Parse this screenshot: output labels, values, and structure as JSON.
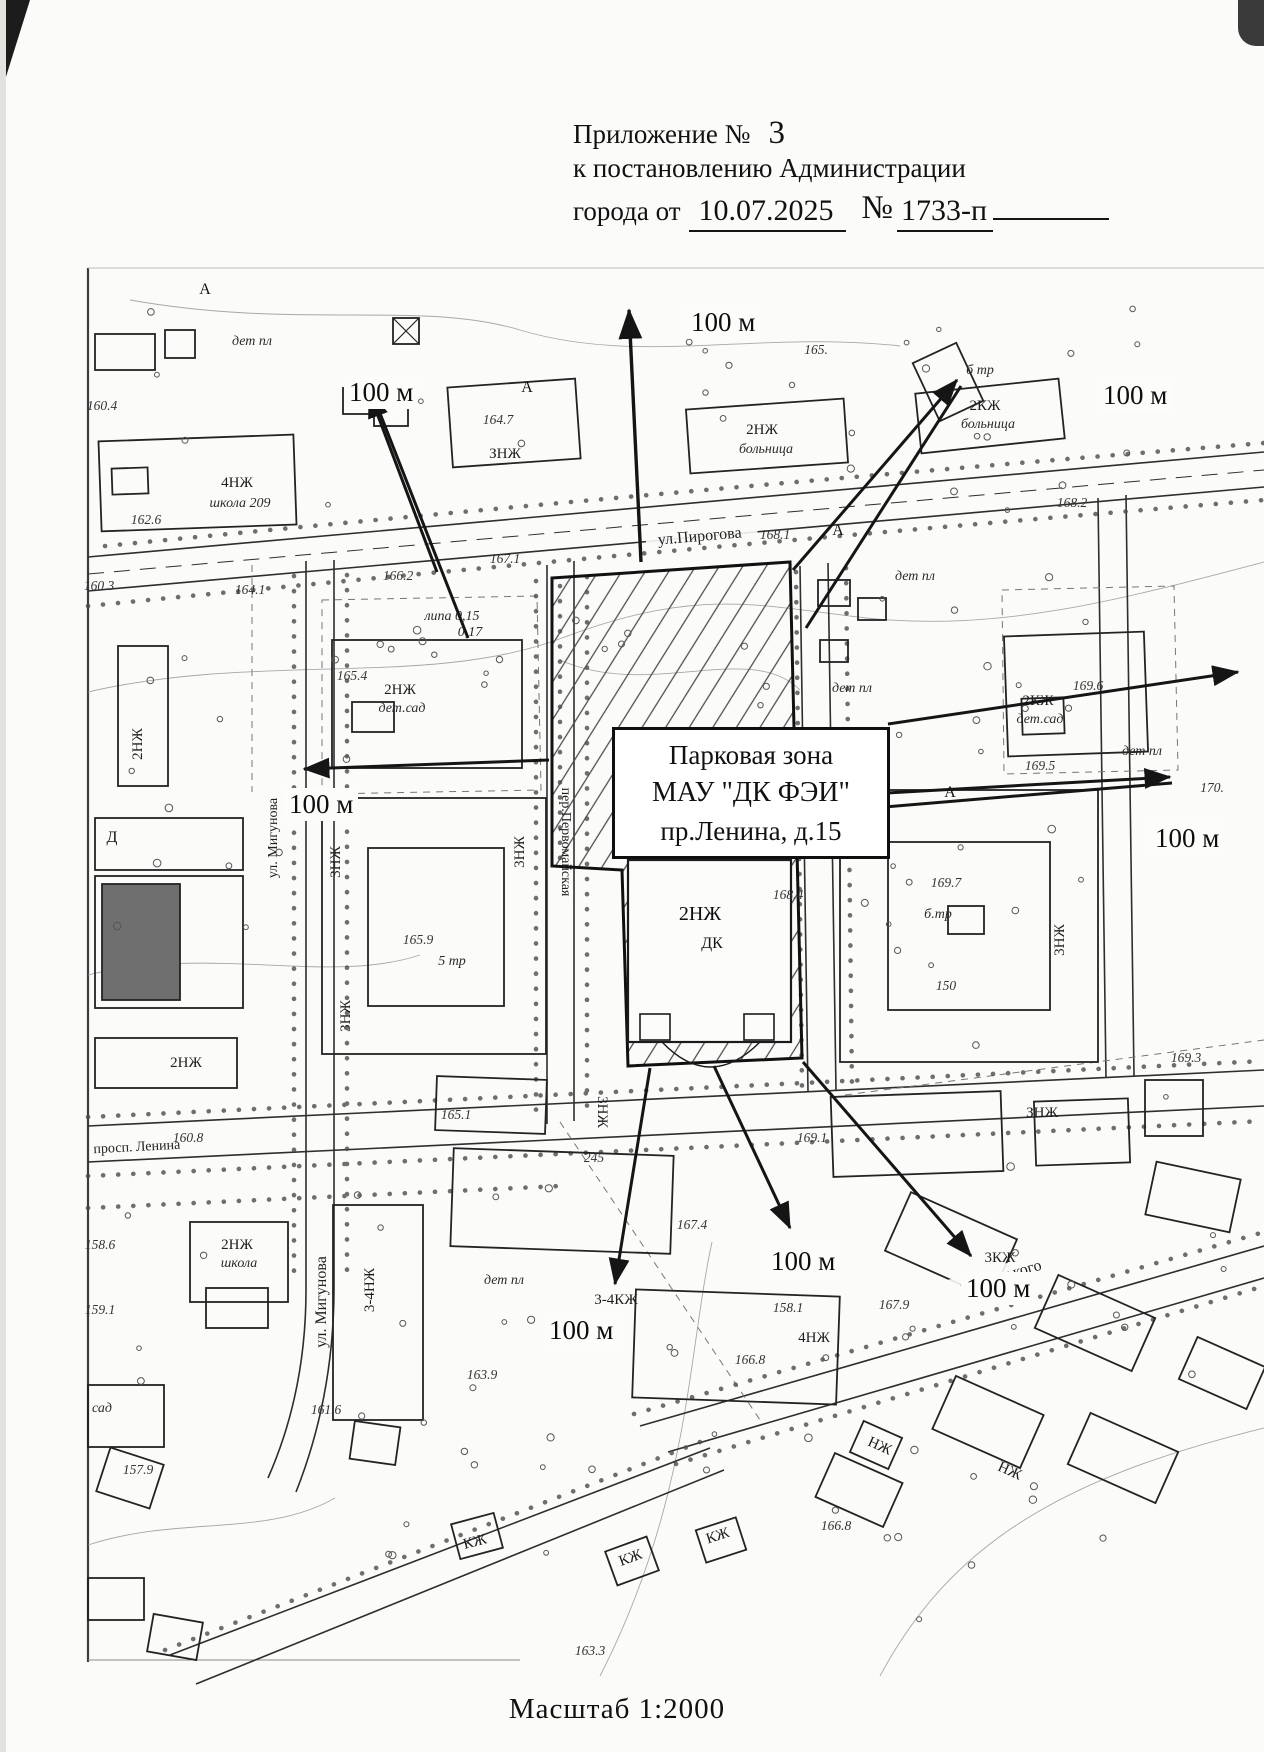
{
  "page": {
    "header": {
      "appendix_label": "Приложение №",
      "appendix_number": "3",
      "line2": "к постановлению Администрации",
      "line3_prefix": "города от",
      "date": "10.07.2025",
      "number_sign": "№",
      "doc_number": "1733-п"
    },
    "scale_label": "Масштаб 1:2000"
  },
  "zone_box": {
    "line1": "Парковая зона",
    "line2": "МАУ \"ДК ФЭИ\"",
    "line3": "пр.Ленина, д.15"
  },
  "arrows": {
    "north": "100 м",
    "north_west": "100 м",
    "north_east": "100 м",
    "west": "100 м",
    "east": "100 м",
    "south": "100 м",
    "south_west": "100 м",
    "south_east": "100 м"
  },
  "streets": {
    "pirogova": "ул.Пирогова",
    "lenina": "просп. Ленина",
    "migunova": "ул. Мигунова",
    "pervomayskaya": "пер.Первомайская",
    "gorkogo": "ул. Горького"
  },
  "buildings": {
    "school209_floors": "4НЖ",
    "school209_name": "школа 209",
    "school_sw_floors": "2НЖ",
    "school_sw_name": "школа",
    "hospital_w_floors": "2НЖ",
    "hospital_w_name": "больница",
    "hospital_e_floors": "2КЖ",
    "hospital_e_name": "больница",
    "kinder_w_floors": "2НЖ",
    "kinder_w_name": "дет.сад",
    "kinder_e_floors": "2КЖ",
    "kinder_e_name": "дет.сад",
    "dk_floors": "2НЖ",
    "dk_name": "ДК",
    "floors_3nzh": "3НЖ",
    "floors_znzh": "ЗНЖ",
    "floors_2nzh": "2НЖ",
    "floors_34kzh": "3-4КЖ",
    "floors_4nzh": "4НЖ",
    "floors_3kzh": "3КЖ",
    "floors_34nzh": "3-4НЖ",
    "floors_kzh": "КЖ",
    "floors_nzh": "НЖ"
  },
  "site_labels": {
    "det_pl": "дет пл",
    "b_tr": "б тр",
    "b_tr2": "б.тр",
    "lipa": "липа 0,15",
    "lipa2": "0,17",
    "tr5": "5 тр",
    "sad": "сад",
    "letter_a": "А",
    "letter_d": "Д"
  },
  "elevations": [
    "160.4",
    "162.6",
    "160.3",
    "164.1",
    "166.2",
    "167.1",
    "164.7",
    "168.1",
    "165.",
    "168.2",
    "169.6",
    "170.",
    "165.4",
    "165.9",
    "169.7",
    "169.5",
    "150",
    "169.1",
    "168.4",
    "245",
    "165.1",
    "160.8",
    "158.6",
    "159.1",
    "167.4",
    "158.1",
    "163.9",
    "167.9",
    "166.8",
    "169.3",
    "161.6",
    "157.9",
    "163.3",
    "166.8"
  ],
  "colors": {
    "ink": "#1a1a1a",
    "paper": "#fbfbfa",
    "contour": "#999999"
  }
}
